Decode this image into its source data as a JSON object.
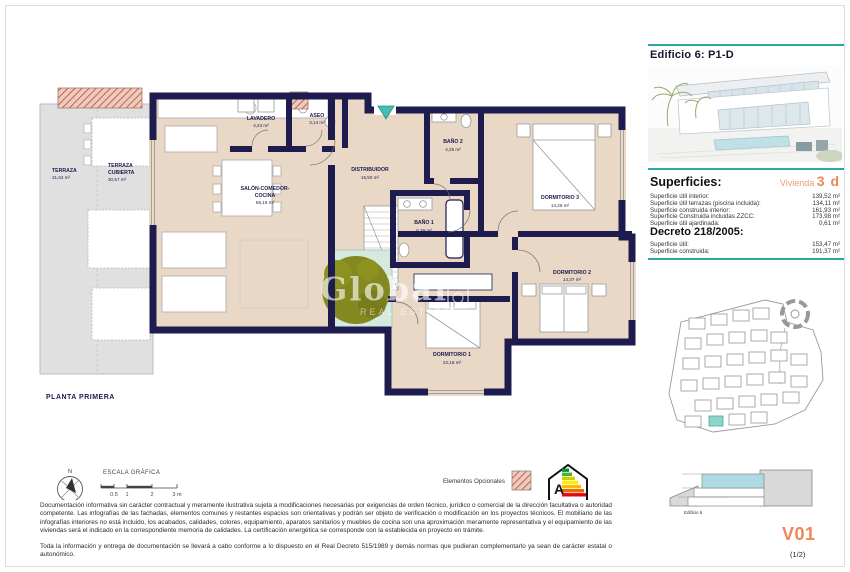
{
  "colors": {
    "accent_teal": "#2BA7A2",
    "accent_orange": "#EE8657",
    "wall_navy": "#1E1C4F",
    "floor_beige": "#E9D8C6",
    "terrace_gray": "#E0E0E0",
    "courtyard_mint": "#D5E9DE",
    "tree_olive": "#83881F",
    "optional_hatch_red": "#A8503C",
    "entrance_marker_teal": "#45BDB3"
  },
  "plan": {
    "title": "PLANTA PRIMERA",
    "watermark": {
      "line1": "Global",
      "line2": "REAL ESTATE"
    },
    "rooms": {
      "terraza": {
        "name": "TERRAZA",
        "area": "31,64 m²"
      },
      "terraza_cubierta": {
        "line1": "TERRAZA",
        "line2": "CUBIERTA",
        "area": "30,57 m²"
      },
      "lavadero": {
        "name": "LAVADERO",
        "area": "4,24 m²"
      },
      "aseo": {
        "name": "ASEO",
        "area": "3,14 m²"
      },
      "distribuidor": {
        "name": "DISTRIBUIDOR",
        "area": "15,50 m²"
      },
      "salon": {
        "line1": "SALÓN-COMEDOR-",
        "line2": "COCINA",
        "area": "56,19 m²"
      },
      "bano2": {
        "name": "BAÑO 2",
        "area": "4,25 m²"
      },
      "dormitorio3": {
        "name": "DORMITORIO 3",
        "area": "14,26 m²"
      },
      "bano1": {
        "name": "BAÑO 1",
        "area": "6,39 m²"
      },
      "dormitorio2": {
        "name": "DORMITORIO 2",
        "area": "14,37 m²"
      },
      "dormitorio1": {
        "name": "DORMITORIO 1",
        "area": "22,18 m²"
      }
    }
  },
  "legend": {
    "scale_title": "ESCALA GRÁFICA",
    "scale_ticks": [
      "0.5",
      "1",
      "2",
      "3 m"
    ],
    "compass_north": "N",
    "optional_label": "Elementos Opcionales",
    "energy_letter": "A"
  },
  "sidebar": {
    "building_title": "Edificio 6: P1-D",
    "superficies_heading": "Superficies:",
    "vivienda_label": "Vivienda",
    "vivienda_type": "3 d",
    "superficies_rows": [
      {
        "label": "Superficie útil interior:",
        "value": "139,52 m²"
      },
      {
        "label": "Superficie útil terrazas (piscina incluida):",
        "value": "134,11 m²"
      },
      {
        "label": "Superficie construida interior:",
        "value": "161,93 m²"
      },
      {
        "label": "Superficie Construida incluidas ZZCC:",
        "value": "173,98 m²"
      },
      {
        "label": "Superficie útil ajardinada:",
        "value": "0,61 m²"
      }
    ],
    "decreto_heading": "Decreto 218/2005:",
    "decreto_rows": [
      {
        "label": "Superficie útil:",
        "value": "153,47 m²"
      },
      {
        "label": "Superficie construida:",
        "value": "191,37 m²"
      }
    ],
    "elevation_caption": "Edificio 6",
    "version": "V01",
    "page_indicator": "(1/2)"
  },
  "footer": {
    "disclaimer1": "Documentación informativa sin carácter contractual y meramente ilustrativa sujeta a modificaciones necesarias por exigencias de orden técnico, jurídico o comercial de la dirección facultativa o autoridad competente. Las infografías de las fachadas, elementos comunes y restantes espacios son orientativas y podrán ser objeto de verificación o modificación en los proyectos técnicos. El mobiliario de las infografías interiores no está incluido, los acabados, calidades, colores, equipamiento, aparatos sanitarios y muebles de cocina son una aproximación meramente representativa y el equipamiento de las viviendas será el indicado en la correspondiente memoria de calidades. La certificación energética se corresponde con la establecida en proyecto en trámite.",
    "disclaimer2": "Toda la información y entrega de documentación se llevará a cabo conforme a lo dispuesto en el Real Decreto 515/1989 y demás normas que pudieran complementarlo ya sean de carácter estatal o autonómico."
  }
}
